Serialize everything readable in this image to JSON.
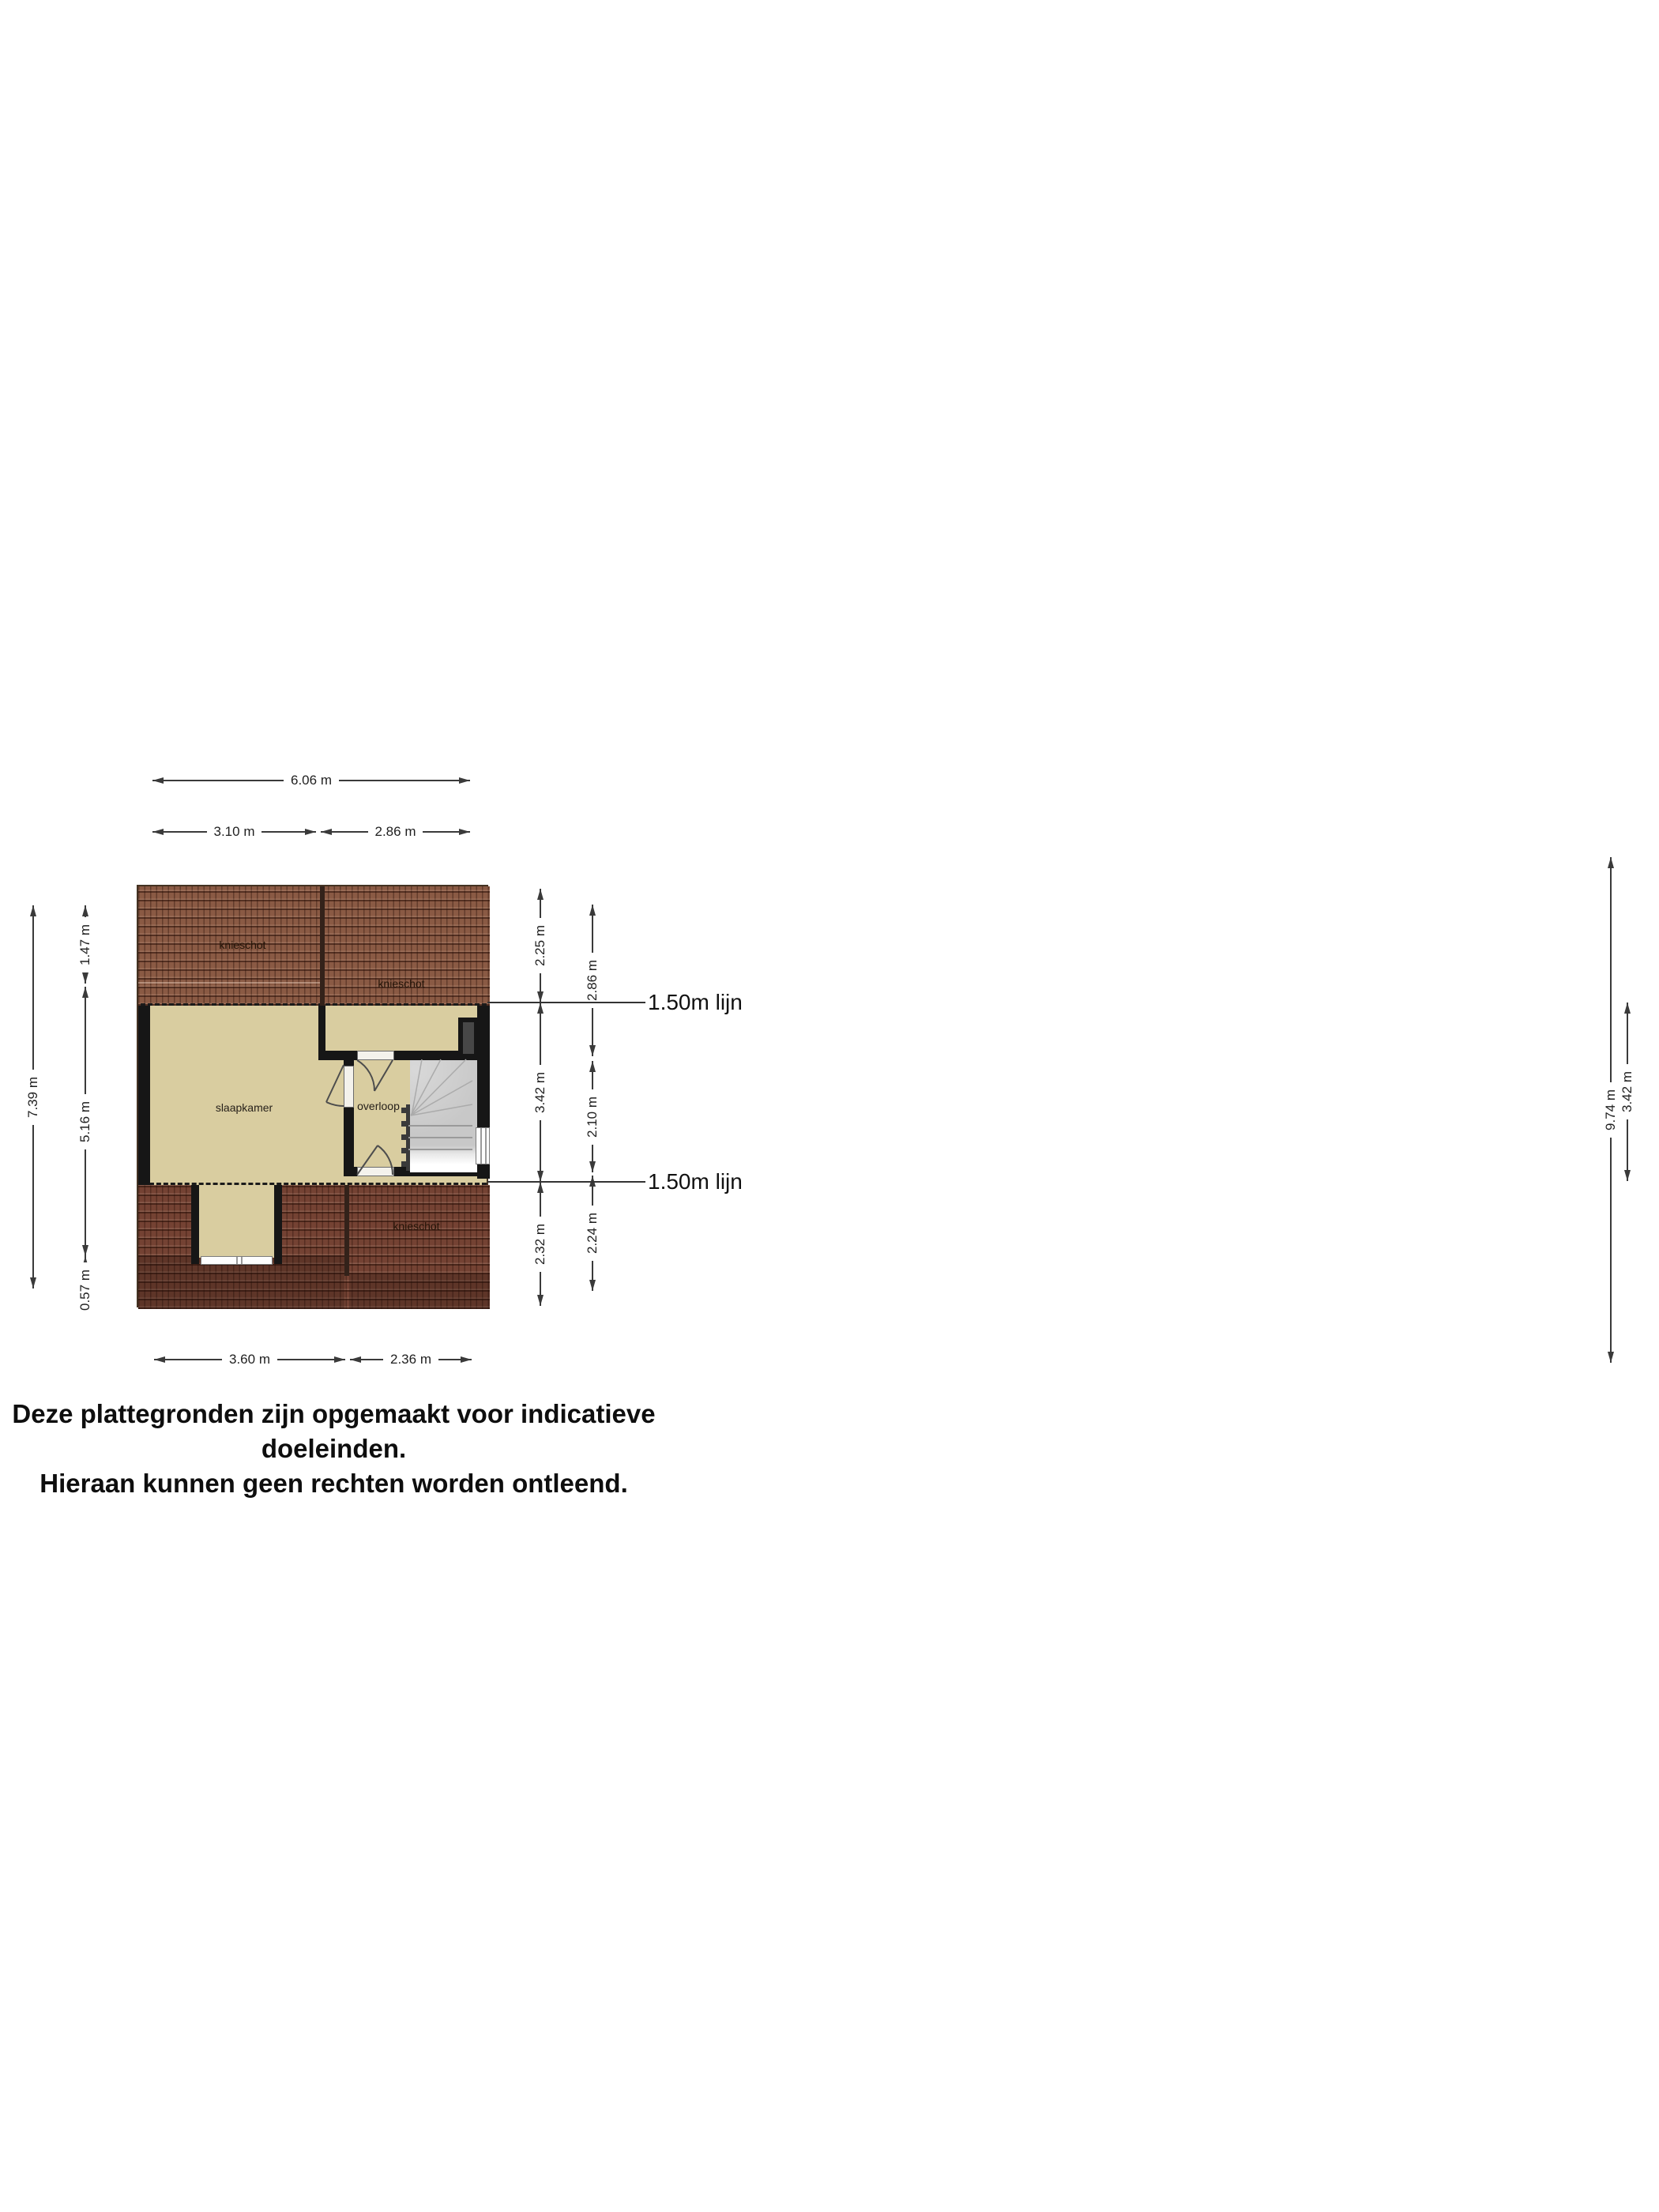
{
  "disclaimer": {
    "line1": "Deze plattegronden zijn opgemaakt voor indicatieve doeleinden.",
    "line2": "Hieraan kunnen geen rechten worden ontleend."
  },
  "floorplan": {
    "rooms": {
      "bedroom_label": "slaapkamer",
      "landing_label": "overloop",
      "knee_wall_top_left_label": "knieschot",
      "knee_wall_top_right_label": "knieschot",
      "knee_wall_bottom_label": "knieschot"
    },
    "annotations": {
      "upper_height_line_label": "1.50m lijn",
      "lower_height_line_label": "1.50m lijn"
    },
    "colors": {
      "floor": "#d9cda0",
      "roof_light": "#8a5a44",
      "roof_dark": "#744233",
      "wall": "#161616",
      "stairs": "#c8c8c8",
      "dimension": "#3a3a3a"
    }
  },
  "dimensions": {
    "top": {
      "total": "6.06 m",
      "left": "3.10 m",
      "right": "2.86 m"
    },
    "bottom": {
      "left": "3.60 m",
      "right": "2.36 m"
    },
    "left_outer": {
      "total": "7.39 m"
    },
    "left_inner": {
      "top": "1.47 m",
      "middle": "5.16 m",
      "bottom": "0.57 m"
    },
    "right_inner": {
      "top": "2.25 m",
      "middle": "3.42 m",
      "bottom": "2.32 m"
    },
    "right_outer": {
      "top": "2.86 m",
      "middle": "2.10 m",
      "bottom": "2.24 m"
    },
    "far_right": {
      "total": "9.74 m",
      "span": "3.42 m"
    }
  }
}
